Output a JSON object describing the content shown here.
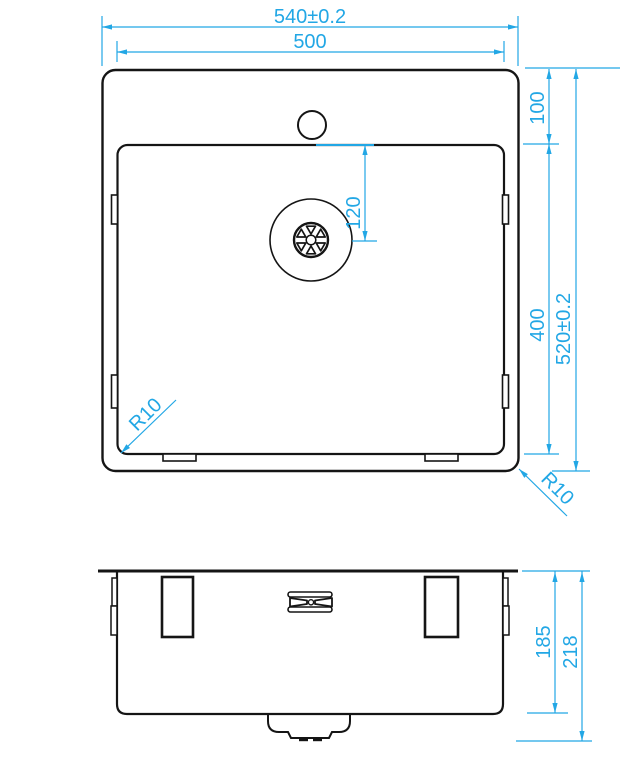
{
  "dims": {
    "outer_width": "540±0.2",
    "inner_width": "500",
    "rim_to_bowl": "100",
    "drain_offset": "120",
    "bowl_length": "400",
    "outer_length": "520±0.2",
    "bowl_corner_radius": "R10",
    "outer_corner_radius": "R10",
    "bowl_depth": "185",
    "total_depth": "218"
  },
  "colors": {
    "dimension": "#22A7E5",
    "line": "#151515",
    "background": "#ffffff"
  }
}
